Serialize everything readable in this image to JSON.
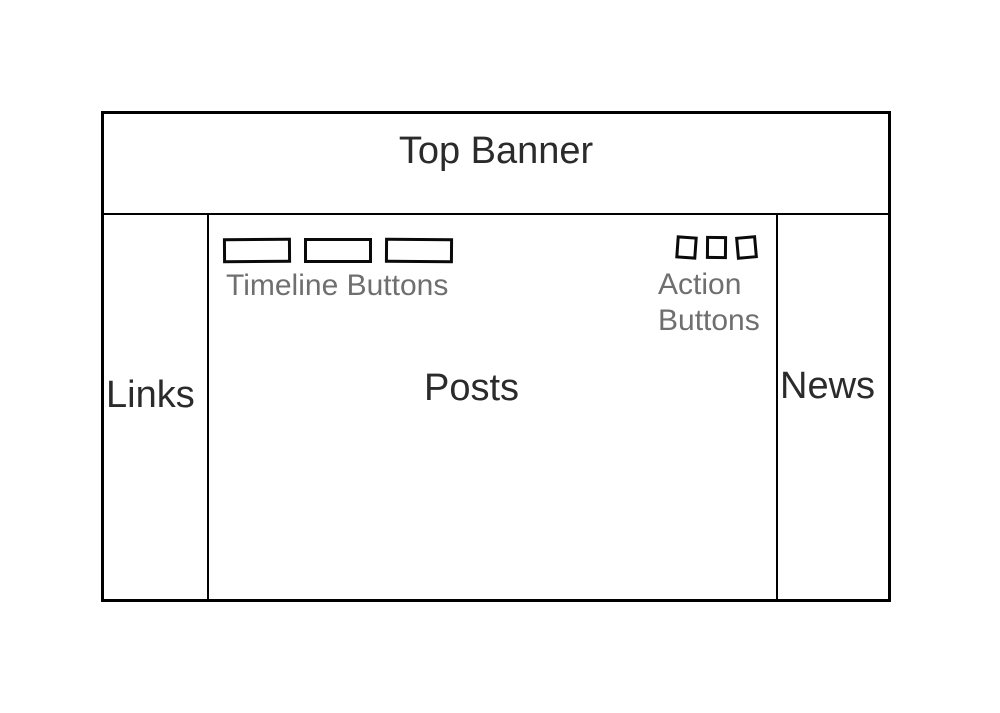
{
  "banner": {
    "label": "Top Banner"
  },
  "sidebar_left": {
    "label": "Links"
  },
  "main": {
    "label": "Posts",
    "timeline": {
      "label": "Timeline Buttons",
      "button_count": 3
    },
    "actions": {
      "label_line1": "Action",
      "label_line2": "Buttons",
      "button_count": 3
    }
  },
  "sidebar_right": {
    "label": "News"
  },
  "colors": {
    "background": "#ffffff",
    "line": "#000000",
    "label_text": "#2b2b2b",
    "caption_text": "#6f6f6f"
  }
}
